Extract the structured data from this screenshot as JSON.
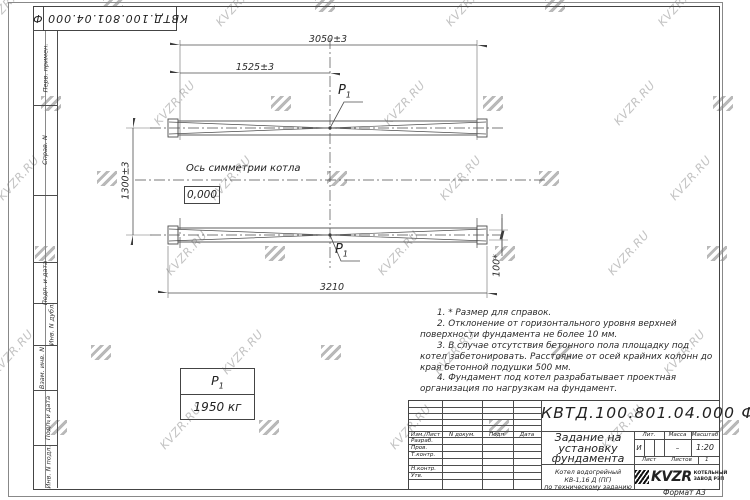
{
  "watermark": {
    "text": "KVZR.RU"
  },
  "stamp": {
    "designation": "КВТД.100.801.04.000  Ф"
  },
  "margin": {
    "labels": [
      "Перв. примен.",
      "Справ. N",
      "Подп. и дата",
      "Инв. N дубл.",
      "Взам. инв. N",
      "Подп. и дата",
      "Инв. N подл."
    ]
  },
  "drawing": {
    "dims": {
      "top": "3050±3",
      "half": "1525±3",
      "height": "1300±3",
      "bottom": "3210",
      "small": "100*"
    },
    "axis_label": "Ось симметрии котла",
    "level_mark": "0,000",
    "load_label": "P",
    "load_sub": "1",
    "load_value": "1950 кг",
    "notes": [
      "1. * Размер для справок.",
      "2. Отклонение от горизонтального уровня верхней поверхности фундамента не более 10 мм.",
      "3. В случае отсутствия бетонного пола площадку под котел забетонировать. Расстояние от осей крайних колонн до края бетонной подушки 500 мм.",
      "4. Фундамент под котел разрабатывает проектная организация по нагрузкам на фундамент."
    ]
  },
  "titleblock": {
    "designation": "КВТД.100.801.04.000  Ф",
    "title": "Задание на установку фундамента",
    "subtitle1": "Котел водогрейный КВ-1,16 Д (ПГ)",
    "subtitle2": "по техническому заданию",
    "col_izm": "Изм./Лист",
    "col_ndoc": "N докум.",
    "col_podp": "Подп.",
    "col_data": "Дата",
    "row_razrab": "Разраб.",
    "row_prov": "Пров.",
    "row_tkontr": "Т.контр.",
    "row_nkontr": "Н.контр.",
    "row_utv": "Утв.",
    "lit_label": "Лит.",
    "mass_label": "Масса",
    "scale_label": "Масштаб",
    "lit_value": "И",
    "mass_value": "–",
    "scale_value": "1:20",
    "sheet_label": "Лист",
    "sheets_label": "Листов",
    "sheets_value": "1",
    "logo_text": "KVZR",
    "company_line1": "КОТЕЛЬНЫЙ",
    "company_line2": "ЗАВОД РЭП",
    "format_note": "Формат А3"
  }
}
